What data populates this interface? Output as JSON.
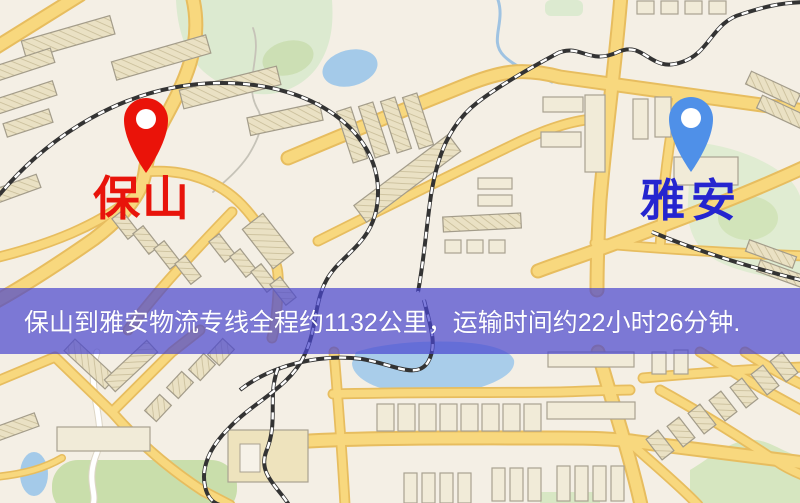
{
  "banner": {
    "text": "保山到雅安物流专线全程约1132公里，运输时间约22小时26分钟.",
    "background_color": "#4946ce",
    "text_color": "#ffffff"
  },
  "markers": {
    "origin": {
      "name": "保山",
      "pin_color": "#ea1309",
      "label_color": "#e8140b",
      "icon": "map-pin"
    },
    "destination": {
      "name": "雅安",
      "pin_color": "#4f90e8",
      "label_color": "#2525cf",
      "icon": "map-pin"
    }
  },
  "map": {
    "background_color": "#f4efe5",
    "road_color": "#f8d87e",
    "road_casing_color": "#e7bd5f",
    "railway_color": "#333333",
    "water_color": "#a4cae9",
    "park_color": "#dcead0",
    "building_color": "#f1ebd8"
  }
}
